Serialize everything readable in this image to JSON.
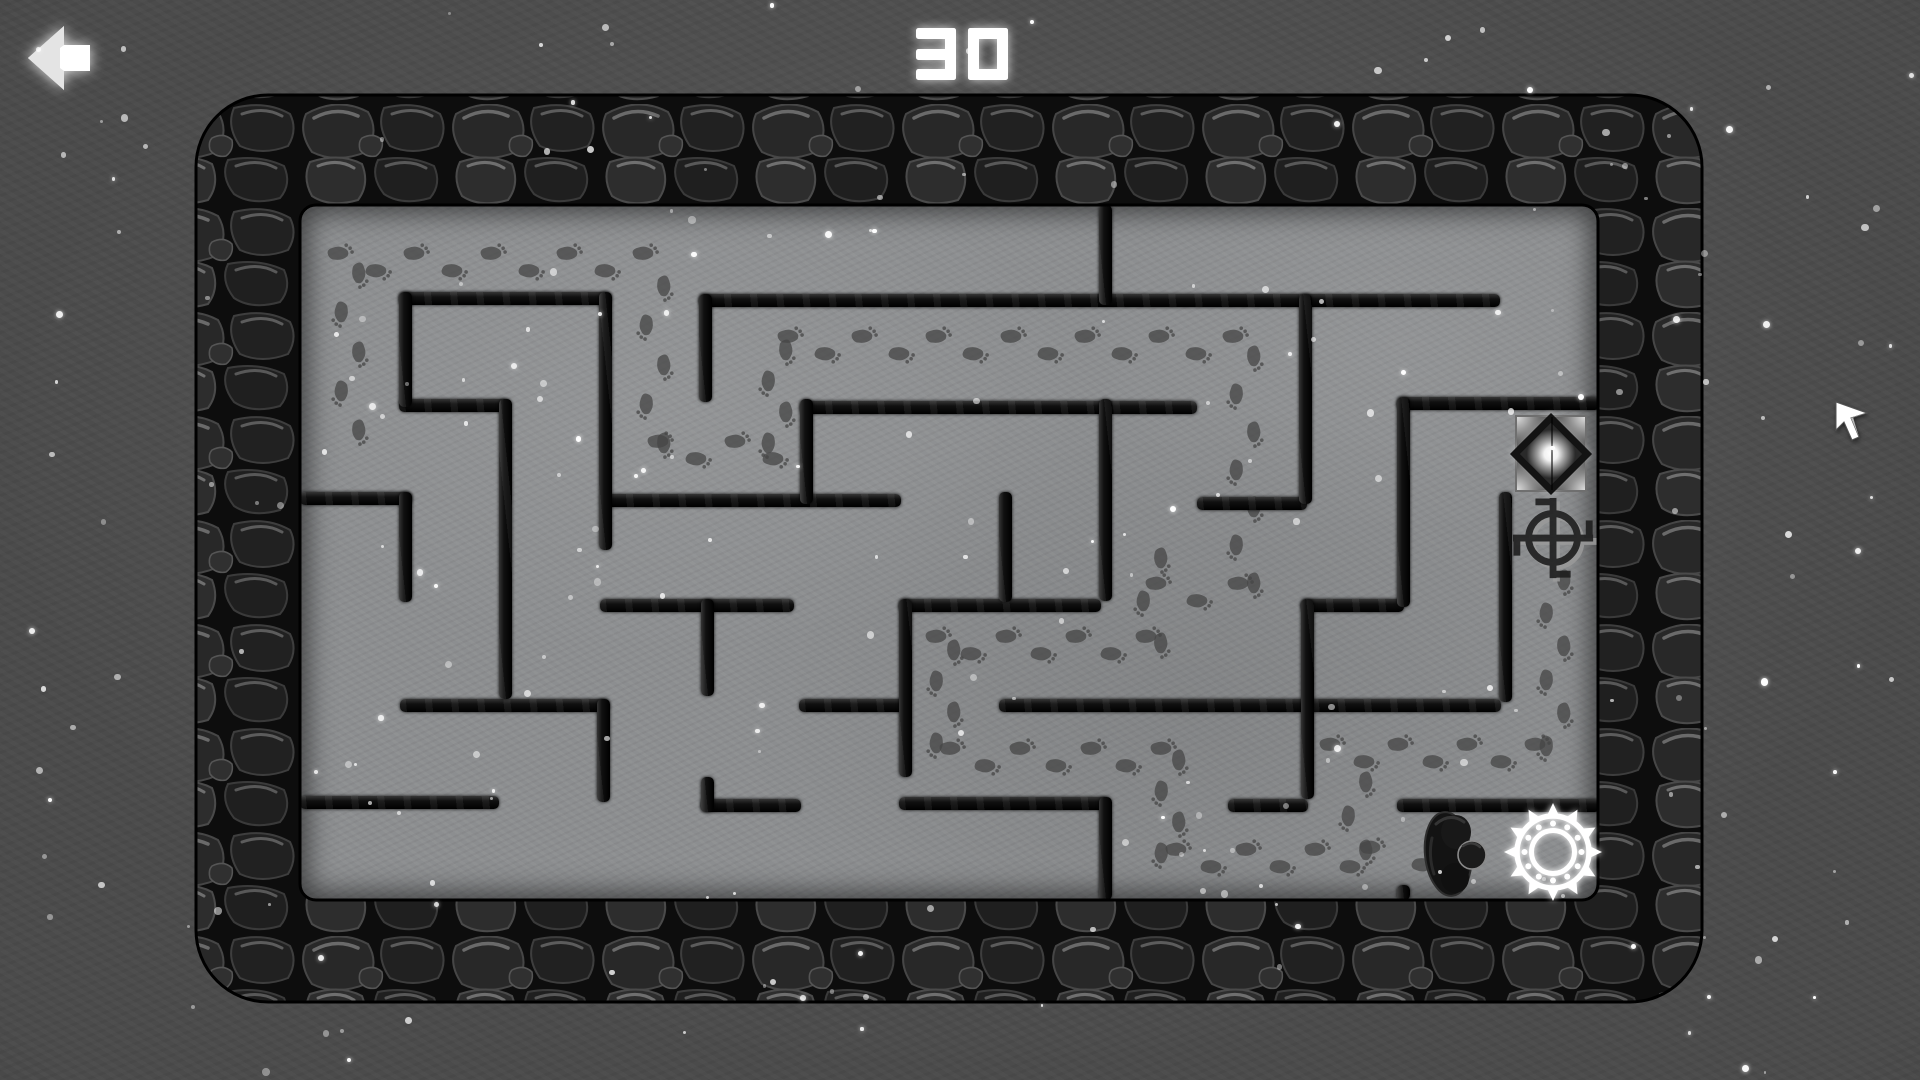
{
  "hud": {
    "level": "30",
    "level_position": {
      "cx": 962,
      "top": 28
    },
    "back": {
      "label": "back",
      "x": 20,
      "y": 18,
      "size": 80
    }
  },
  "colors": {
    "background": "#4b4b4b",
    "floor": "#8c8e90",
    "wall": "#0b0b0b",
    "rock_base": "#0d0d0d",
    "rock_stone": "#272727",
    "rock_highlight": "#636363",
    "footprint": "#454545",
    "glow_white": "#ffffff"
  },
  "maze": {
    "outer": {
      "x": 196,
      "y": 95,
      "w": 1506,
      "h": 907,
      "radius": 72
    },
    "inner": {
      "x": 300,
      "y": 205,
      "w": 1298,
      "h": 695
    },
    "walls": [
      [
        399,
        292,
        212,
        13
      ],
      [
        699,
        294,
        801,
        13
      ],
      [
        399,
        399,
        110,
        13
      ],
      [
        800,
        401,
        397,
        13
      ],
      [
        1397,
        397,
        203,
        13
      ],
      [
        300,
        492,
        112,
        13
      ],
      [
        601,
        494,
        300,
        13
      ],
      [
        1197,
        497,
        110,
        13
      ],
      [
        600,
        599,
        194,
        13
      ],
      [
        899,
        599,
        202,
        13
      ],
      [
        1301,
        599,
        103,
        13
      ],
      [
        400,
        699,
        209,
        13
      ],
      [
        799,
        699,
        107,
        13
      ],
      [
        999,
        699,
        502,
        13
      ],
      [
        300,
        796,
        199,
        13
      ],
      [
        701,
        799,
        100,
        13
      ],
      [
        899,
        797,
        210,
        13
      ],
      [
        1228,
        799,
        80,
        13
      ],
      [
        1397,
        799,
        203,
        13
      ],
      [
        399,
        292,
        13,
        115
      ],
      [
        399,
        492,
        13,
        110
      ],
      [
        499,
        399,
        13,
        300
      ],
      [
        599,
        292,
        13,
        258
      ],
      [
        597,
        699,
        13,
        103
      ],
      [
        699,
        294,
        13,
        108
      ],
      [
        701,
        599,
        13,
        97
      ],
      [
        701,
        777,
        13,
        35
      ],
      [
        800,
        399,
        13,
        105
      ],
      [
        899,
        599,
        13,
        178
      ],
      [
        999,
        492,
        13,
        110
      ],
      [
        1099,
        205,
        13,
        100
      ],
      [
        1099,
        399,
        13,
        202
      ],
      [
        1099,
        797,
        13,
        103
      ],
      [
        1299,
        294,
        13,
        210
      ],
      [
        1301,
        599,
        13,
        200
      ],
      [
        1397,
        397,
        13,
        210
      ],
      [
        1499,
        492,
        13,
        210
      ],
      [
        1397,
        885,
        13,
        15
      ]
    ],
    "trails": [
      [
        340,
        262,
        645,
        262
      ],
      [
        350,
        275,
        350,
        432
      ],
      [
        655,
        288,
        655,
        445
      ],
      [
        660,
        450,
        775,
        450
      ],
      [
        777,
        352,
        777,
        445
      ],
      [
        790,
        345,
        1235,
        345
      ],
      [
        1245,
        358,
        1245,
        585
      ],
      [
        1158,
        592,
        1240,
        592
      ],
      [
        1152,
        560,
        1152,
        645
      ],
      [
        938,
        645,
        1148,
        645
      ],
      [
        945,
        652,
        945,
        745
      ],
      [
        952,
        757,
        1163,
        757
      ],
      [
        1170,
        762,
        1170,
        855
      ],
      [
        1178,
        858,
        1352,
        858
      ],
      [
        1357,
        784,
        1357,
        852
      ],
      [
        1332,
        753,
        1537,
        753
      ],
      [
        1555,
        582,
        1555,
        748
      ],
      [
        1372,
        856,
        1424,
        856
      ]
    ],
    "objects": {
      "goal_diamond": {
        "x": 1515,
        "y": 415,
        "w": 72,
        "h": 77
      },
      "compass_marker": {
        "cx": 1555,
        "cy": 540,
        "size": 88
      },
      "player_creature": {
        "x": 1422,
        "y": 808,
        "w": 70,
        "h": 92
      },
      "gear_marker": {
        "cx": 1553,
        "cy": 852,
        "r": 47
      }
    }
  },
  "cursor": {
    "x": 1833,
    "y": 400
  }
}
